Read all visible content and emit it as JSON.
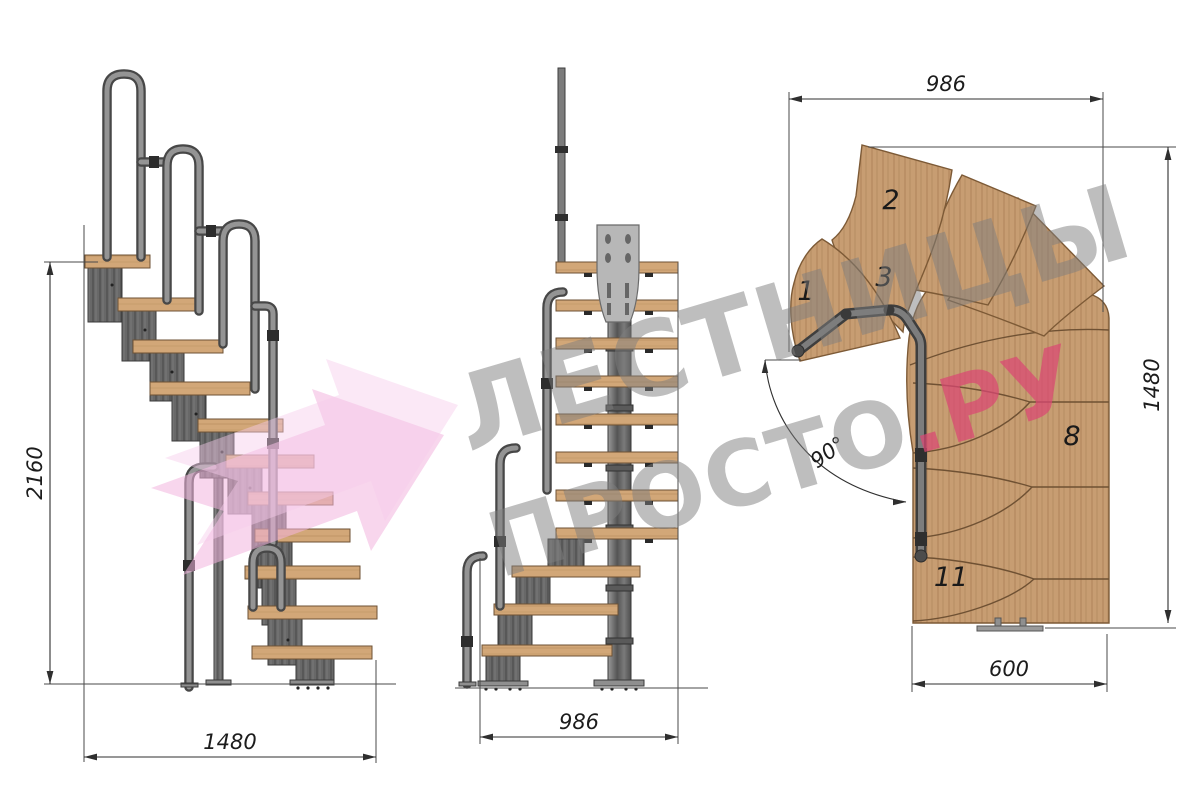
{
  "dimensions": {
    "side_total_height": "2160",
    "side_total_width": "1480",
    "front_width": "986",
    "plan_top_width": "986",
    "plan_right_height": "1480",
    "plan_bottom_width": "600",
    "plan_turn_angle": "90°"
  },
  "plan_step_numbers": {
    "first": "1",
    "second": "2",
    "third": "3",
    "eighth": "8",
    "eleventh": "11"
  },
  "watermark": {
    "line1": "ЛЕСТНИЦЫ",
    "line2_gray": "ПРОСТО",
    "line2_pink": ".РУ"
  },
  "colors": {
    "background": "#ffffff",
    "wood": "#c59a6e",
    "wood_grain": "#a87f52",
    "metal_module": "#686868",
    "metal_outline": "#3a3a3a",
    "handrail_tube": "#949494",
    "mount_plate": "#b7b7b7",
    "dimension_line": "#2f2f2f",
    "watermark_gray": "#7d7d7d",
    "watermark_pink": "#db4673",
    "logo_pink": "#f3b5de"
  }
}
